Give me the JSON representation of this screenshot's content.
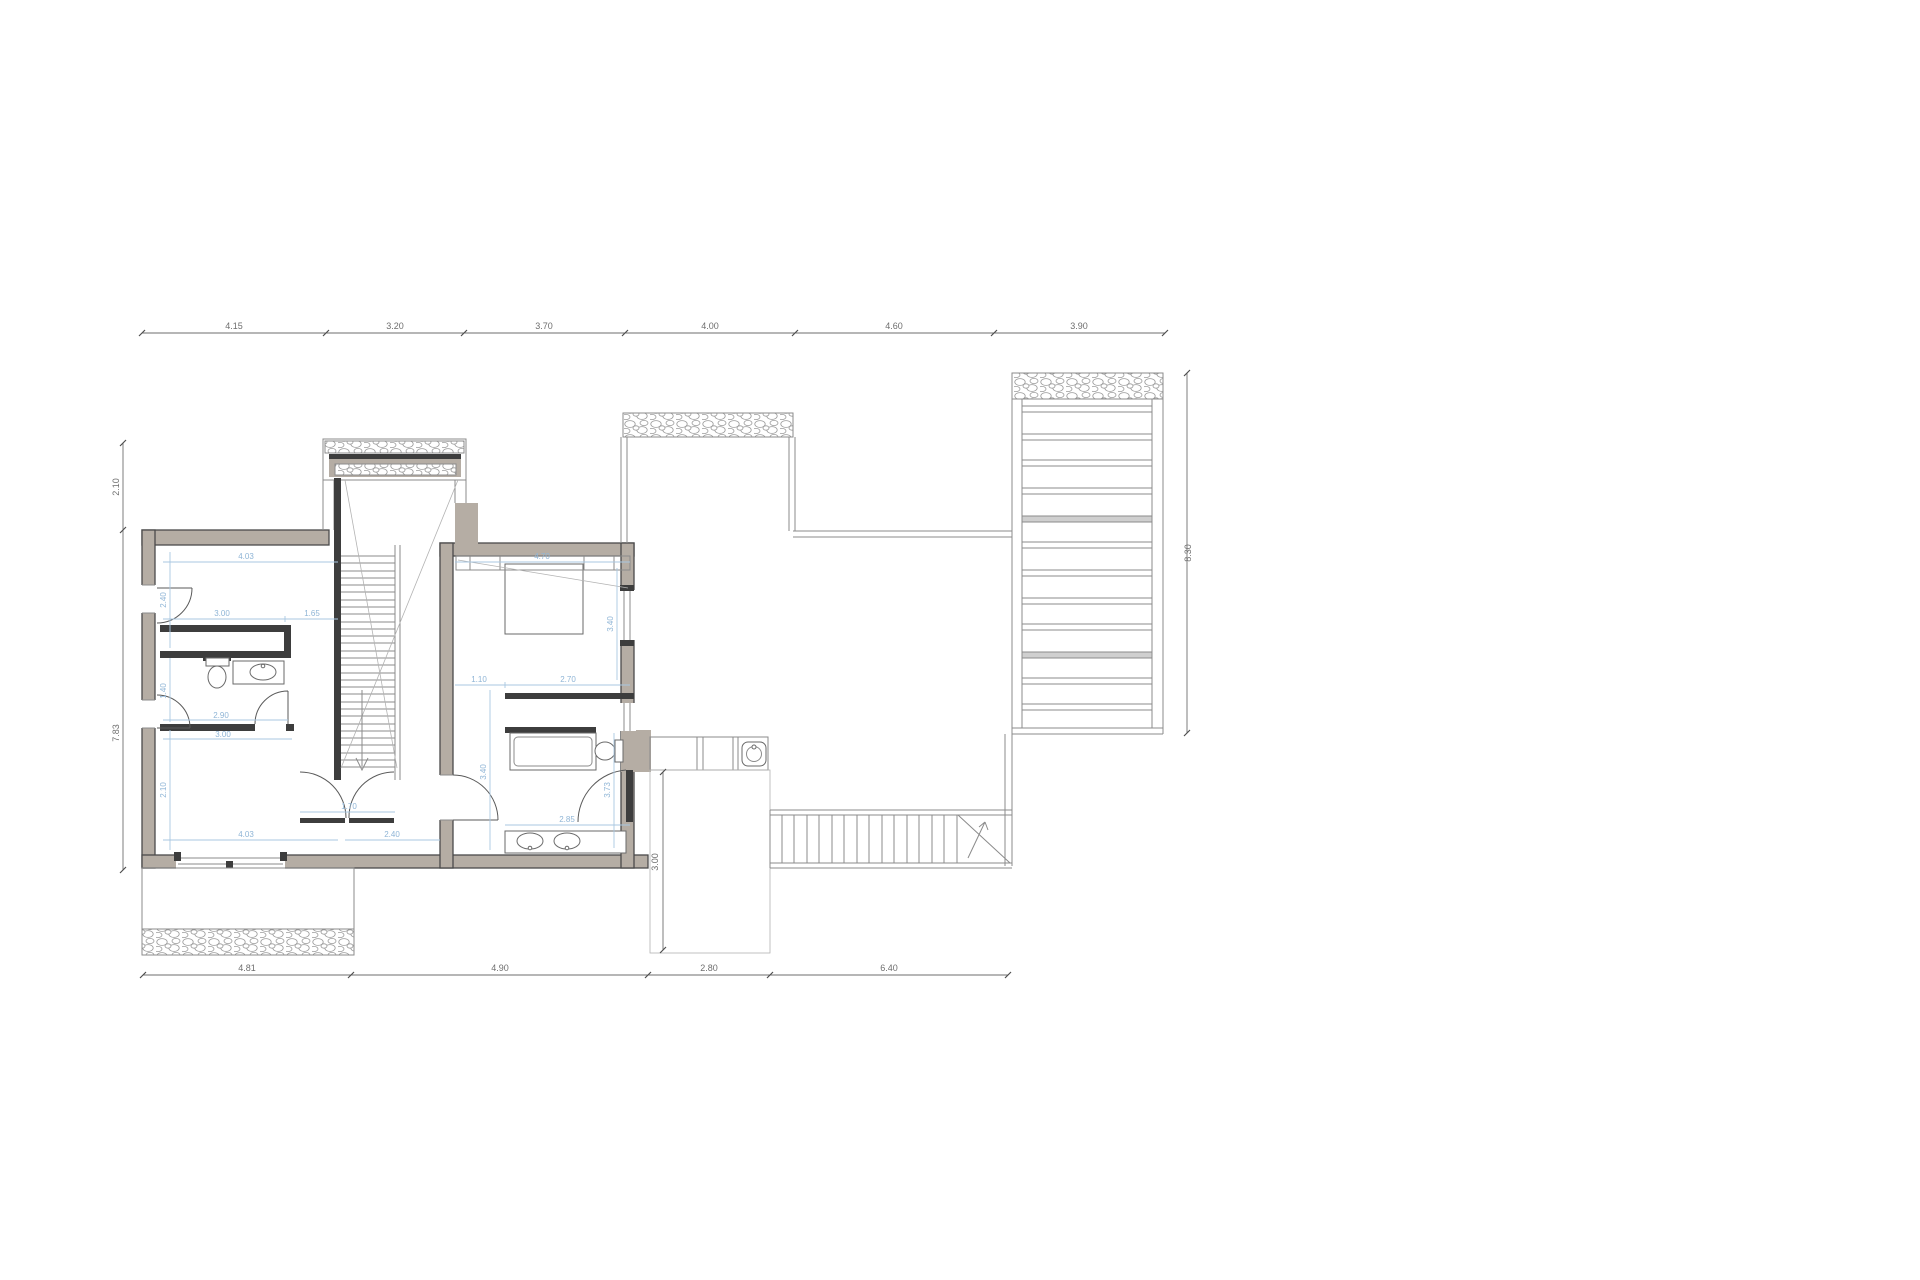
{
  "plan": {
    "dims_top": [
      "4.15",
      "3.20",
      "3.70",
      "4.00",
      "4.60",
      "3.90"
    ],
    "dims_bottom": [
      "4.81",
      "4.90",
      "2.80",
      "6.40"
    ],
    "dims_left": [
      "2.10",
      "7.83"
    ],
    "dims_right": [
      "8.30"
    ],
    "dims_room_left": {
      "width_top": "4.03",
      "height_top": "2.40",
      "closet_w": "3.00",
      "closet_side": "1.65",
      "bath_h": "1.40",
      "bath_w": "2.90",
      "hall_w": "3.00",
      "room2_h": "2.10",
      "room2_w": "4.03",
      "door_w": "1.70",
      "hall_b": "2.40"
    },
    "dims_bedroom": {
      "width_top": "4.70",
      "height_right": "3.40",
      "entry_w": "1.10",
      "closet_w": "2.70",
      "bath_h": "3.40",
      "bath_door": "3.73",
      "vanity_w": "2.85",
      "terrace_d": "3.00"
    },
    "colors": {
      "wall_fill": "#b5ada4",
      "wall_stroke": "#4a4a4a",
      "partition": "#3d3d3d",
      "thin_line": "#8b8b8b",
      "dim_text": "#6e6e6e",
      "dim_blue": "#9fc3df"
    }
  }
}
